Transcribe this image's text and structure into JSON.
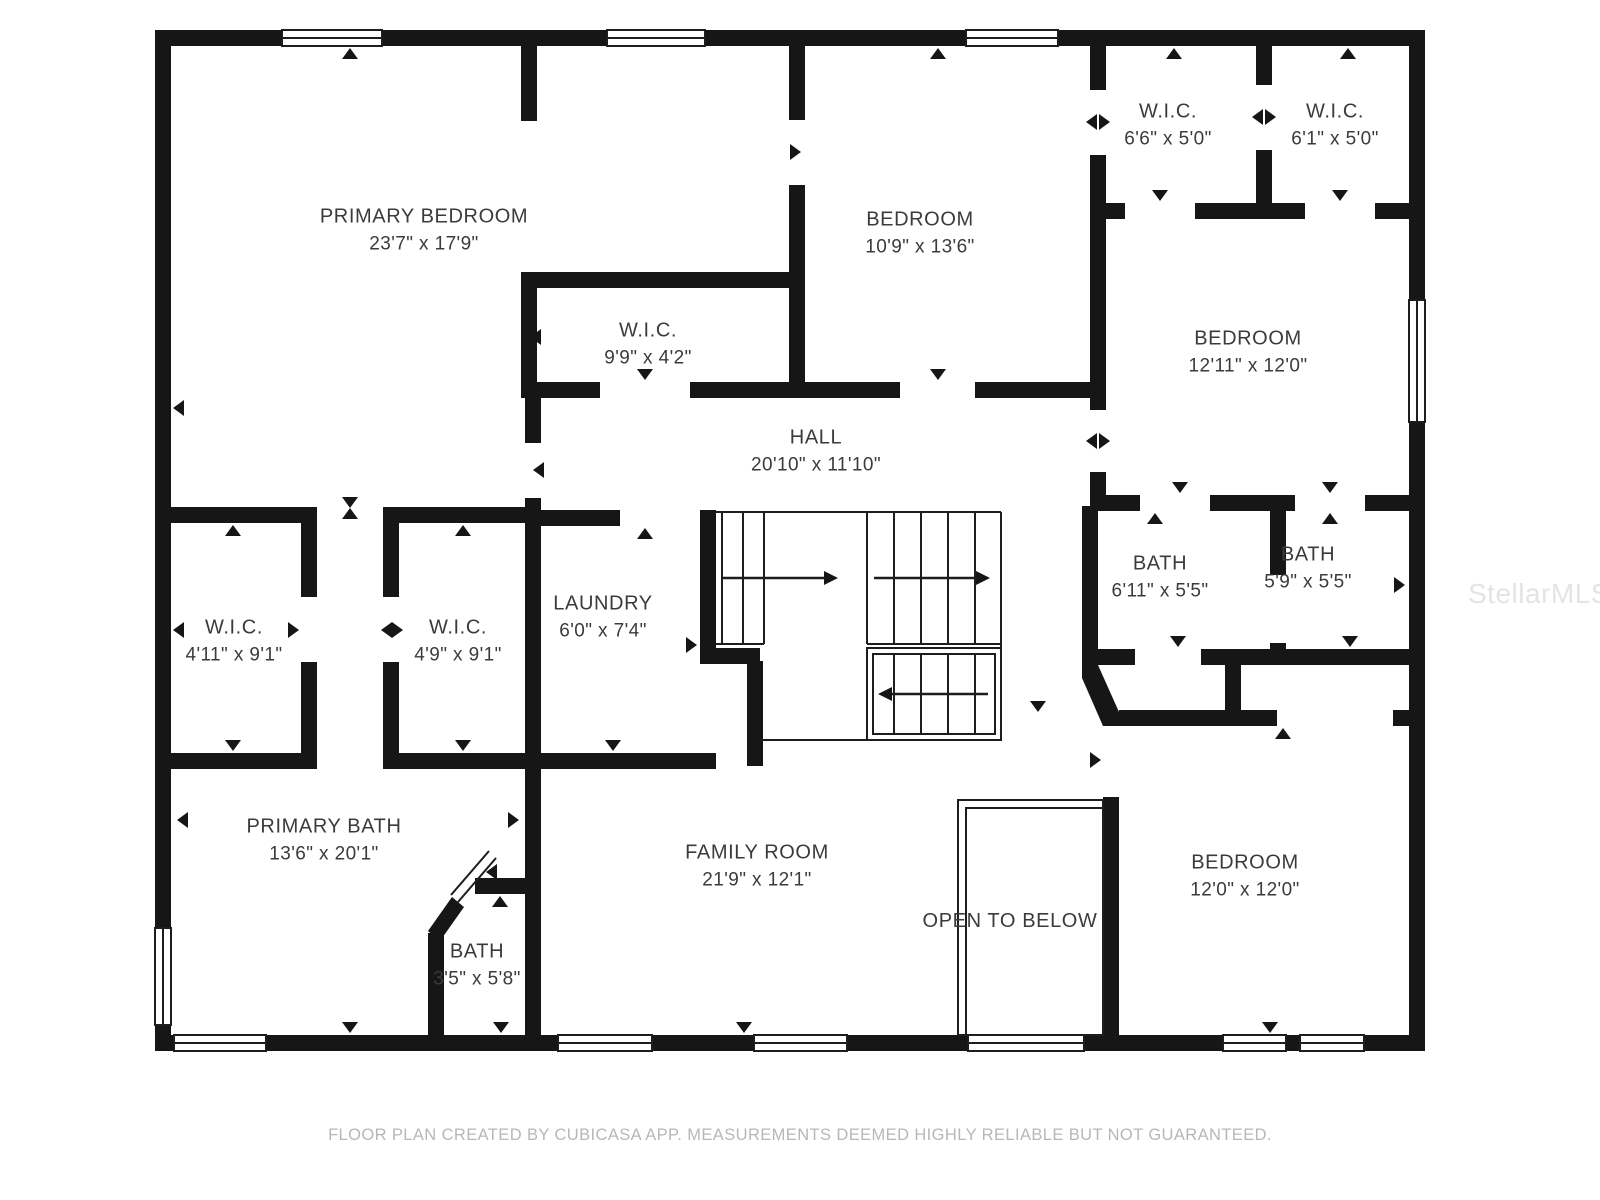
{
  "floor_plan": {
    "rooms": {
      "primary_bedroom": {
        "name": "PRIMARY BEDROOM",
        "dims": "23'7\" x 17'9\""
      },
      "wic_99": {
        "name": "W.I.C.",
        "dims": "9'9\" x 4'2\""
      },
      "bedroom_109": {
        "name": "BEDROOM",
        "dims": "10'9\" x 13'6\""
      },
      "wic_66": {
        "name": "W.I.C.",
        "dims": "6'6\" x 5'0\""
      },
      "wic_61": {
        "name": "W.I.C.",
        "dims": "6'1\" x 5'0\""
      },
      "bedroom_1211": {
        "name": "BEDROOM",
        "dims": "12'11\" x 12'0\""
      },
      "hall": {
        "name": "HALL",
        "dims": "20'10\" x 11'10\""
      },
      "wic_411": {
        "name": "W.I.C.",
        "dims": "4'11\" x 9'1\""
      },
      "wic_49": {
        "name": "W.I.C.",
        "dims": "4'9\" x 9'1\""
      },
      "laundry": {
        "name": "LAUNDRY",
        "dims": "6'0\" x 7'4\""
      },
      "bath_611": {
        "name": "BATH",
        "dims": "6'11\" x 5'5\""
      },
      "bath_59": {
        "name": "BATH",
        "dims": "5'9\" x 5'5\""
      },
      "primary_bath": {
        "name": "PRIMARY BATH",
        "dims": "13'6\" x 20'1\""
      },
      "bath_35": {
        "name": "BATH",
        "dims": "3'5\" x 5'8\""
      },
      "family_room": {
        "name": "FAMILY ROOM",
        "dims": "21'9\" x 12'1\""
      },
      "bedroom_120": {
        "name": "BEDROOM",
        "dims": "12'0\" x 12'0\""
      },
      "open_to_below": {
        "name": "OPEN TO BELOW"
      }
    },
    "footer": {
      "caption": "FLOOR PLAN CREATED BY CUBICASA APP. MEASUREMENTS DEEMED HIGHLY RELIABLE BUT NOT GUARANTEED."
    },
    "watermark": "StellarMLS",
    "colors": {
      "background": "#ffffff",
      "wall": "#161616",
      "thin_line": "#1d1d1d",
      "label_text": "#3b3b3b",
      "caption_text": "#b7b7b7",
      "watermark_text": "#e4e4e4"
    }
  }
}
